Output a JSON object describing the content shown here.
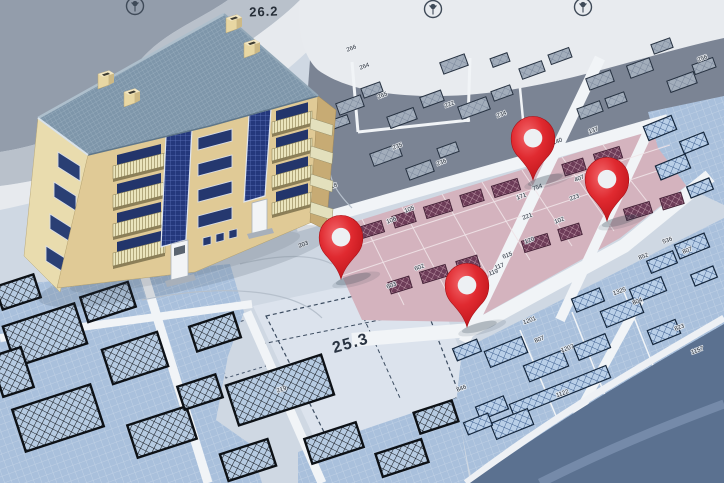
{
  "scene": {
    "title": "3D apartment building model on cadastral city map with red location pins",
    "type": "cadastral-map-composite"
  },
  "map": {
    "area_labels": [
      {
        "text": "26.2"
      },
      {
        "text": "25.3"
      },
      {
        "text": ".6"
      },
      {
        "text": "219"
      }
    ],
    "parcel_labels": [
      [
        "266",
        352,
        50
      ],
      [
        "264",
        365,
        68
      ],
      [
        "265",
        383,
        97
      ],
      [
        "222",
        450,
        106
      ],
      [
        "234",
        502,
        116
      ],
      [
        "235",
        398,
        148
      ],
      [
        "236",
        442,
        164
      ],
      [
        "218",
        333,
        188
      ],
      [
        "215",
        306,
        224
      ],
      [
        "203",
        304,
        246
      ],
      [
        "108",
        336,
        232
      ],
      [
        "105",
        410,
        211
      ],
      [
        "106",
        392,
        222
      ],
      [
        "256",
        703,
        60
      ],
      [
        "137",
        594,
        132
      ],
      [
        "140",
        558,
        143
      ],
      [
        "407",
        580,
        180
      ],
      [
        "408",
        614,
        179
      ],
      [
        "754",
        538,
        189
      ],
      [
        "171",
        522,
        198
      ],
      [
        "223",
        575,
        199
      ],
      [
        "221",
        528,
        218
      ],
      [
        "102",
        560,
        222
      ],
      [
        "120",
        530,
        242
      ],
      [
        "615",
        508,
        257
      ],
      [
        "117",
        500,
        268
      ],
      [
        "119",
        494,
        274
      ],
      [
        "602",
        420,
        269
      ],
      [
        "603",
        392,
        287
      ],
      [
        "536",
        668,
        242
      ],
      [
        "852",
        644,
        258
      ],
      [
        "807",
        688,
        252
      ],
      [
        "1325",
        620,
        293
      ],
      [
        "804",
        638,
        303
      ],
      [
        "823",
        680,
        329
      ],
      [
        "1157",
        698,
        352
      ],
      [
        "1201",
        530,
        322
      ],
      [
        "807",
        540,
        341
      ],
      [
        "1207",
        568,
        350
      ],
      [
        "1122",
        563,
        395
      ],
      [
        "846",
        462,
        390
      ]
    ],
    "colors": {
      "base": "#cfd8e3",
      "gray_district": "#7b8494",
      "pink_zone": "#d4b3be",
      "blue_parcels": "#a9c0dc",
      "road": "#f1f4f7",
      "water": "#5b7190",
      "parcel_outline": "#16243a"
    },
    "icons": [
      "tree-icon",
      "location-pin-icon"
    ]
  },
  "pins": [
    {
      "name": "location-pin-1",
      "x": 533,
      "y": 180
    },
    {
      "name": "location-pin-2",
      "x": 607,
      "y": 221
    },
    {
      "name": "location-pin-3",
      "x": 341,
      "y": 279
    },
    {
      "name": "location-pin-4",
      "x": 467,
      "y": 327
    }
  ],
  "building": {
    "name": "apartment-building-model",
    "visible_floors": 4,
    "chimneys": 4,
    "balcony_stacks": 2,
    "doors": 2,
    "colors": {
      "roof": "#7e96aa",
      "front_wall": "#e0ca96",
      "side_wall": "#e9dcae",
      "windows": "#25386f",
      "balcony_railing": "#eae4bc",
      "door": "#f2f4f6",
      "pin_red": "#d31f26"
    }
  }
}
